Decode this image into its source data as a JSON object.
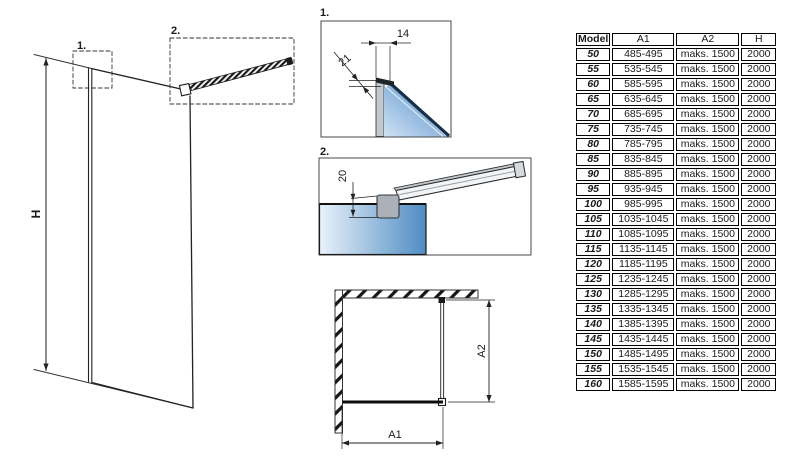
{
  "diagram": {
    "main_view": {
      "height_label": "H",
      "detail1_ref": "1.",
      "detail2_ref": "2."
    },
    "detail1": {
      "label": "1.",
      "dim_top": "14",
      "dim_side": "21"
    },
    "detail2": {
      "label": "2.",
      "dim_drop": "20"
    },
    "plan_view": {
      "width_label": "A1",
      "depth_label": "A2"
    }
  },
  "table": {
    "headers": [
      "Model",
      "A1",
      "A2",
      "H"
    ],
    "rows": [
      [
        "50",
        "485-495",
        "maks. 1500",
        "2000"
      ],
      [
        "55",
        "535-545",
        "maks. 1500",
        "2000"
      ],
      [
        "60",
        "585-595",
        "maks. 1500",
        "2000"
      ],
      [
        "65",
        "635-645",
        "maks. 1500",
        "2000"
      ],
      [
        "70",
        "685-695",
        "maks. 1500",
        "2000"
      ],
      [
        "75",
        "735-745",
        "maks. 1500",
        "2000"
      ],
      [
        "80",
        "785-795",
        "maks. 1500",
        "2000"
      ],
      [
        "85",
        "835-845",
        "maks. 1500",
        "2000"
      ],
      [
        "90",
        "885-895",
        "maks. 1500",
        "2000"
      ],
      [
        "95",
        "935-945",
        "maks. 1500",
        "2000"
      ],
      [
        "100",
        "985-995",
        "maks. 1500",
        "2000"
      ],
      [
        "105",
        "1035-1045",
        "maks. 1500",
        "2000"
      ],
      [
        "110",
        "1085-1095",
        "maks. 1500",
        "2000"
      ],
      [
        "115",
        "1135-1145",
        "maks. 1500",
        "2000"
      ],
      [
        "120",
        "1185-1195",
        "maks. 1500",
        "2000"
      ],
      [
        "125",
        "1235-1245",
        "maks. 1500",
        "2000"
      ],
      [
        "130",
        "1285-1295",
        "maks. 1500",
        "2000"
      ],
      [
        "135",
        "1335-1345",
        "maks. 1500",
        "2000"
      ],
      [
        "140",
        "1385-1395",
        "maks. 1500",
        "2000"
      ],
      [
        "145",
        "1435-1445",
        "maks. 1500",
        "2000"
      ],
      [
        "150",
        "1485-1495",
        "maks. 1500",
        "2000"
      ],
      [
        "155",
        "1535-1545",
        "maks. 1500",
        "2000"
      ],
      [
        "160",
        "1585-1595",
        "maks. 1500",
        "2000"
      ]
    ]
  },
  "colors": {
    "line": "#222222",
    "glass_light": "#e9f2fa",
    "glass_dark": "#3f76ae",
    "glass_edge_navy": "#15304d",
    "profile_gray": "#c3c8cd"
  }
}
